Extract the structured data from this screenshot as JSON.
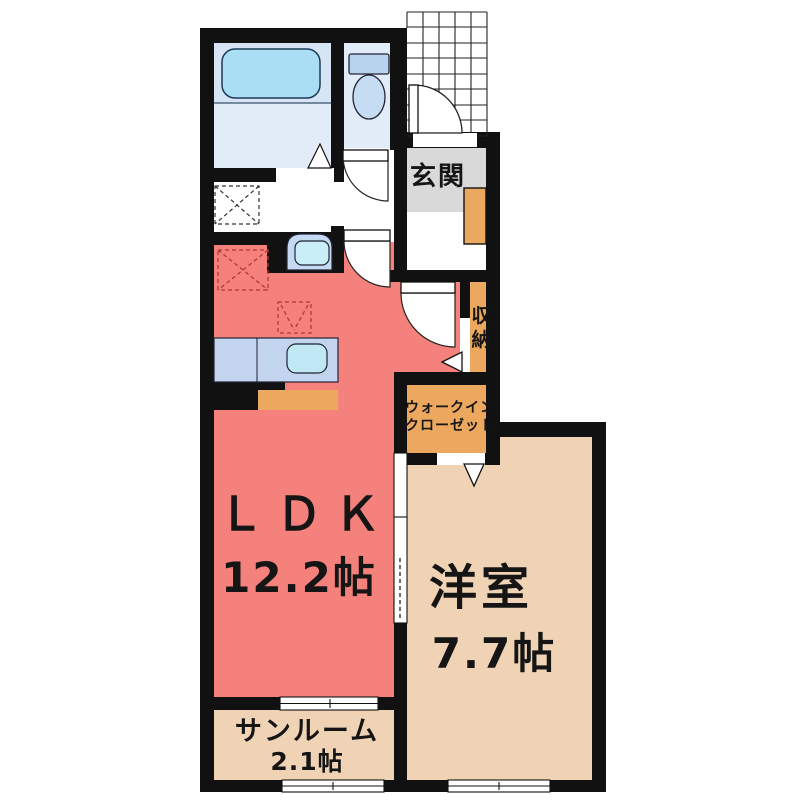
{
  "floor_plan": {
    "rooms": {
      "ldk": {
        "label": "ＬＤＫ",
        "size": "12.2帖"
      },
      "western_room": {
        "label": "洋室",
        "size": "7.7帖"
      },
      "sunroom": {
        "label": "サンルーム",
        "size": "2.1帖"
      },
      "entrance": {
        "label": "玄関"
      },
      "storage": {
        "label": "収納"
      },
      "walk_in_closet": {
        "lines": [
          "ウォークイン",
          "クローゼット"
        ]
      }
    },
    "colors": {
      "ldk": "#f4817b",
      "western_room": "#f0d3b4",
      "sunroom": "#f0d3b4",
      "storage_orange": "#eca85f",
      "entrance_gray": "#d9d9d9",
      "bathroom_upper": "#d6e4f4",
      "bathroom_lower": "#e2ecf8",
      "toilet_room": "#e2ecf8",
      "tub_blue": "#aadef4",
      "counter_blue": "#c3d4ee",
      "sink_blue": "#c0e8f4",
      "wall": "#111111"
    },
    "fixtures": [
      "bathtub",
      "toilet",
      "wash-basin",
      "kitchen-counter",
      "kitchen-sink",
      "washing-machine-space",
      "refrigerator-space",
      "gas-range-space",
      "shoe-cabinet",
      "entrance-porch-hatch",
      "entrance-door"
    ]
  }
}
